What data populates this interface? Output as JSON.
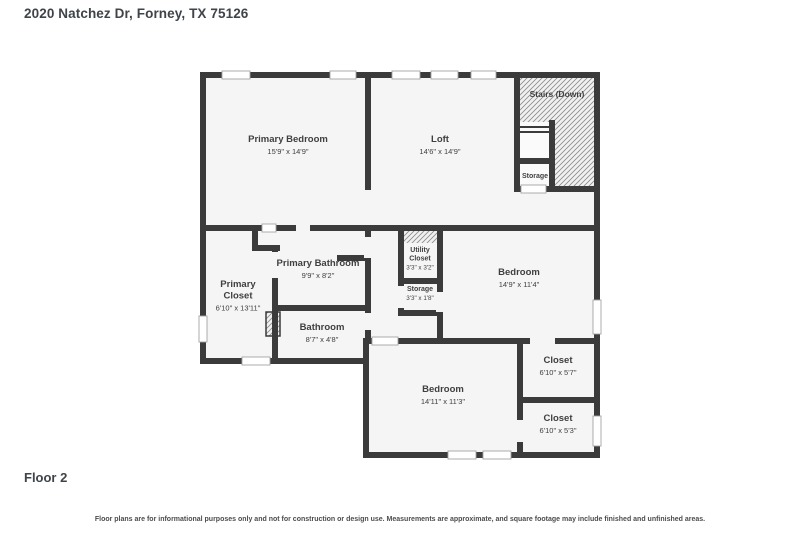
{
  "page": {
    "title": "2020 Natchez Dr, Forney, TX 75126",
    "floor_label": "Floor 2",
    "disclaimer": "Floor plans are for informational purposes only and not for construction or design use. Measurements are approximate, and square footage may include finished and unfinished areas."
  },
  "colors": {
    "wall": "#3b3b3b",
    "floor": "#f5f5f5",
    "outside": "#ffffff",
    "text": "#3f3f3f",
    "window_fill": "#ffffff",
    "window_stroke": "#a3a3a3",
    "hatch_bg": "#f1f1f1",
    "hatch_line": "#8a8a8a",
    "cutout": "#fafafa"
  },
  "plan": {
    "floor_polygon": "203,75 597,75 597,455 366,455 366,361 203,361",
    "walls": [
      [
        200,
        72,
        400,
        6
      ],
      [
        594,
        72,
        6,
        386
      ],
      [
        363,
        452,
        237,
        6
      ],
      [
        363,
        338,
        6,
        120
      ],
      [
        200,
        358,
        169,
        6
      ],
      [
        200,
        72,
        6,
        292
      ],
      [
        365,
        72,
        6,
        118
      ],
      [
        200,
        225,
        400,
        6
      ],
      [
        514,
        72,
        6,
        120
      ],
      [
        514,
        186,
        86,
        6
      ],
      [
        549,
        120,
        6,
        72
      ],
      [
        514,
        158,
        41,
        6
      ],
      [
        252,
        225,
        6,
        26
      ],
      [
        252,
        245,
        28,
        6
      ],
      [
        272,
        248,
        6,
        116
      ],
      [
        365,
        231,
        6,
        113
      ],
      [
        272,
        305,
        99,
        6
      ],
      [
        337,
        255,
        34,
        6
      ],
      [
        398,
        231,
        6,
        85
      ],
      [
        437,
        231,
        6,
        113
      ],
      [
        398,
        278,
        45,
        6
      ],
      [
        398,
        310,
        45,
        6
      ],
      [
        363,
        338,
        237,
        6
      ],
      [
        517,
        344,
        6,
        108
      ],
      [
        517,
        397,
        83,
        6
      ]
    ],
    "windows": [
      [
        222,
        71,
        28,
        8
      ],
      [
        330,
        71,
        26,
        8
      ],
      [
        392,
        71,
        28,
        8
      ],
      [
        431,
        71,
        27,
        8
      ],
      [
        471,
        71,
        25,
        8
      ],
      [
        593,
        300,
        8,
        34
      ],
      [
        593,
        416,
        8,
        30
      ],
      [
        448,
        451,
        28,
        8
      ],
      [
        483,
        451,
        28,
        8
      ],
      [
        242,
        357,
        28,
        8
      ],
      [
        199,
        316,
        8,
        26
      ],
      [
        262,
        224,
        14,
        8
      ],
      [
        372,
        337,
        26,
        8
      ],
      [
        521,
        185,
        25,
        8
      ]
    ],
    "doors": [
      [
        296,
        224,
        14,
        8
      ],
      [
        364,
        237,
        8,
        21
      ],
      [
        364,
        313,
        8,
        17
      ],
      [
        271,
        252,
        8,
        26
      ],
      [
        436,
        292,
        8,
        20
      ],
      [
        530,
        337,
        25,
        8
      ],
      [
        516,
        420,
        8,
        22
      ],
      [
        397,
        286,
        8,
        22
      ]
    ],
    "hatches": [
      [
        520,
        78,
        74,
        108,
        0
      ],
      [
        404,
        231,
        33,
        12,
        0
      ],
      [
        266,
        312,
        14,
        24,
        1
      ]
    ],
    "cutouts": [
      [
        520,
        122,
        29,
        64
      ]
    ],
    "stair_lines": [
      [
        520,
        127,
        549,
        127
      ],
      [
        520,
        132,
        549,
        132
      ]
    ],
    "rooms": [
      {
        "id": "primary-bedroom",
        "label": "Primary Bedroom",
        "dims": "15'9\" x 14'9\"",
        "x": 288,
        "y": 142,
        "size": "md"
      },
      {
        "id": "loft",
        "label": "Loft",
        "dims": "14'6\" x 14'9\"",
        "x": 440,
        "y": 142,
        "size": "md"
      },
      {
        "id": "stairs-down",
        "label": "Stairs (Down)",
        "dims": "",
        "x": 557,
        "y": 97,
        "size": "sm"
      },
      {
        "id": "stairs-storage",
        "label": "Storage",
        "dims": "",
        "x": 535,
        "y": 178,
        "size": "xs"
      },
      {
        "id": "utility-closet",
        "label": "Utility|Closet",
        "dims": "3'3\" x 3'2\"",
        "x": 420,
        "y": 252,
        "size": "xs"
      },
      {
        "id": "storage",
        "label": "Storage",
        "dims": "3'3\" x 1'8\"",
        "x": 420,
        "y": 291,
        "size": "xs"
      },
      {
        "id": "primary-bathroom",
        "label": "Primary Bathroom",
        "dims": "9'9\" x 8'2\"",
        "x": 318,
        "y": 266,
        "size": "md"
      },
      {
        "id": "bedroom-right",
        "label": "Bedroom",
        "dims": "14'9\" x 11'4\"",
        "x": 519,
        "y": 275,
        "size": "md"
      },
      {
        "id": "primary-closet",
        "label": "Primary|Closet",
        "dims": "6'10\" x 13'11\"",
        "x": 238,
        "y": 287,
        "size": "md"
      },
      {
        "id": "bathroom",
        "label": "Bathroom",
        "dims": "8'7\" x 4'8\"",
        "x": 322,
        "y": 330,
        "size": "md"
      },
      {
        "id": "bedroom-bottom",
        "label": "Bedroom",
        "dims": "14'11\" x 11'3\"",
        "x": 443,
        "y": 392,
        "size": "md"
      },
      {
        "id": "closet-top",
        "label": "Closet",
        "dims": "6'10\" x 5'7\"",
        "x": 558,
        "y": 363,
        "size": "md"
      },
      {
        "id": "closet-bottom",
        "label": "Closet",
        "dims": "6'10\" x 5'3\"",
        "x": 558,
        "y": 421,
        "size": "md"
      }
    ]
  }
}
